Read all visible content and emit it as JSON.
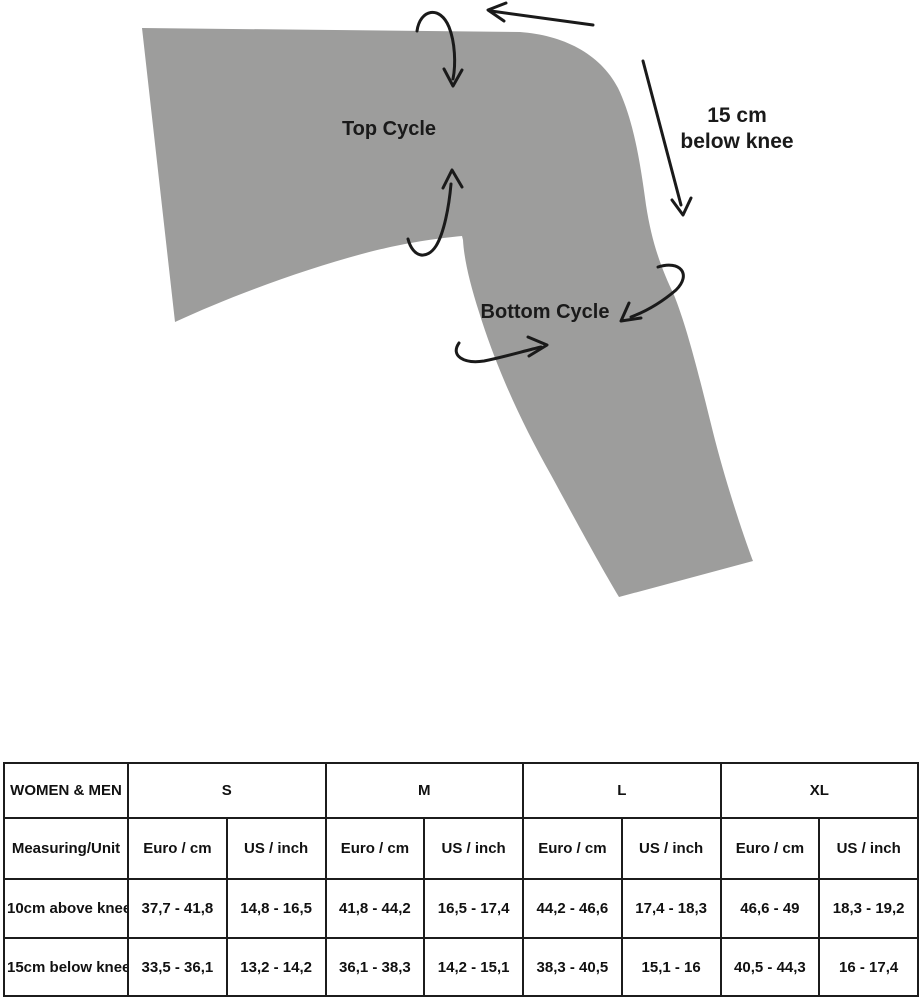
{
  "colors": {
    "leg_fill": "#9d9d9c",
    "ink": "#1a1a1a",
    "background": "#ffffff"
  },
  "diagram": {
    "top_cycle_label": "Top Cycle",
    "bottom_cycle_label": "Bottom Cycle",
    "below_knee_note": {
      "line1": "15 cm",
      "line2": "below knee"
    }
  },
  "size_table": {
    "corner_header": "WOMEN & MEN",
    "measuring_unit_header": "Measuring/Unit",
    "sizes": [
      "S",
      "M",
      "L",
      "XL"
    ],
    "unit_columns": [
      "Euro / cm",
      "US / inch"
    ],
    "rows": [
      {
        "label": "10cm above knee",
        "values": [
          "37,7 - 41,8",
          "14,8 - 16,5",
          "41,8 - 44,2",
          "16,5 - 17,4",
          "44,2 - 46,6",
          "17,4 - 18,3",
          "46,6 - 49",
          "18,3 - 19,2"
        ]
      },
      {
        "label": "15cm below knee",
        "values": [
          "33,5 - 36,1",
          "13,2 - 14,2",
          "36,1 - 38,3",
          "14,2 - 15,1",
          "38,3 - 40,5",
          "15,1 - 16",
          "40,5 - 44,3",
          "16 - 17,4"
        ]
      }
    ]
  }
}
